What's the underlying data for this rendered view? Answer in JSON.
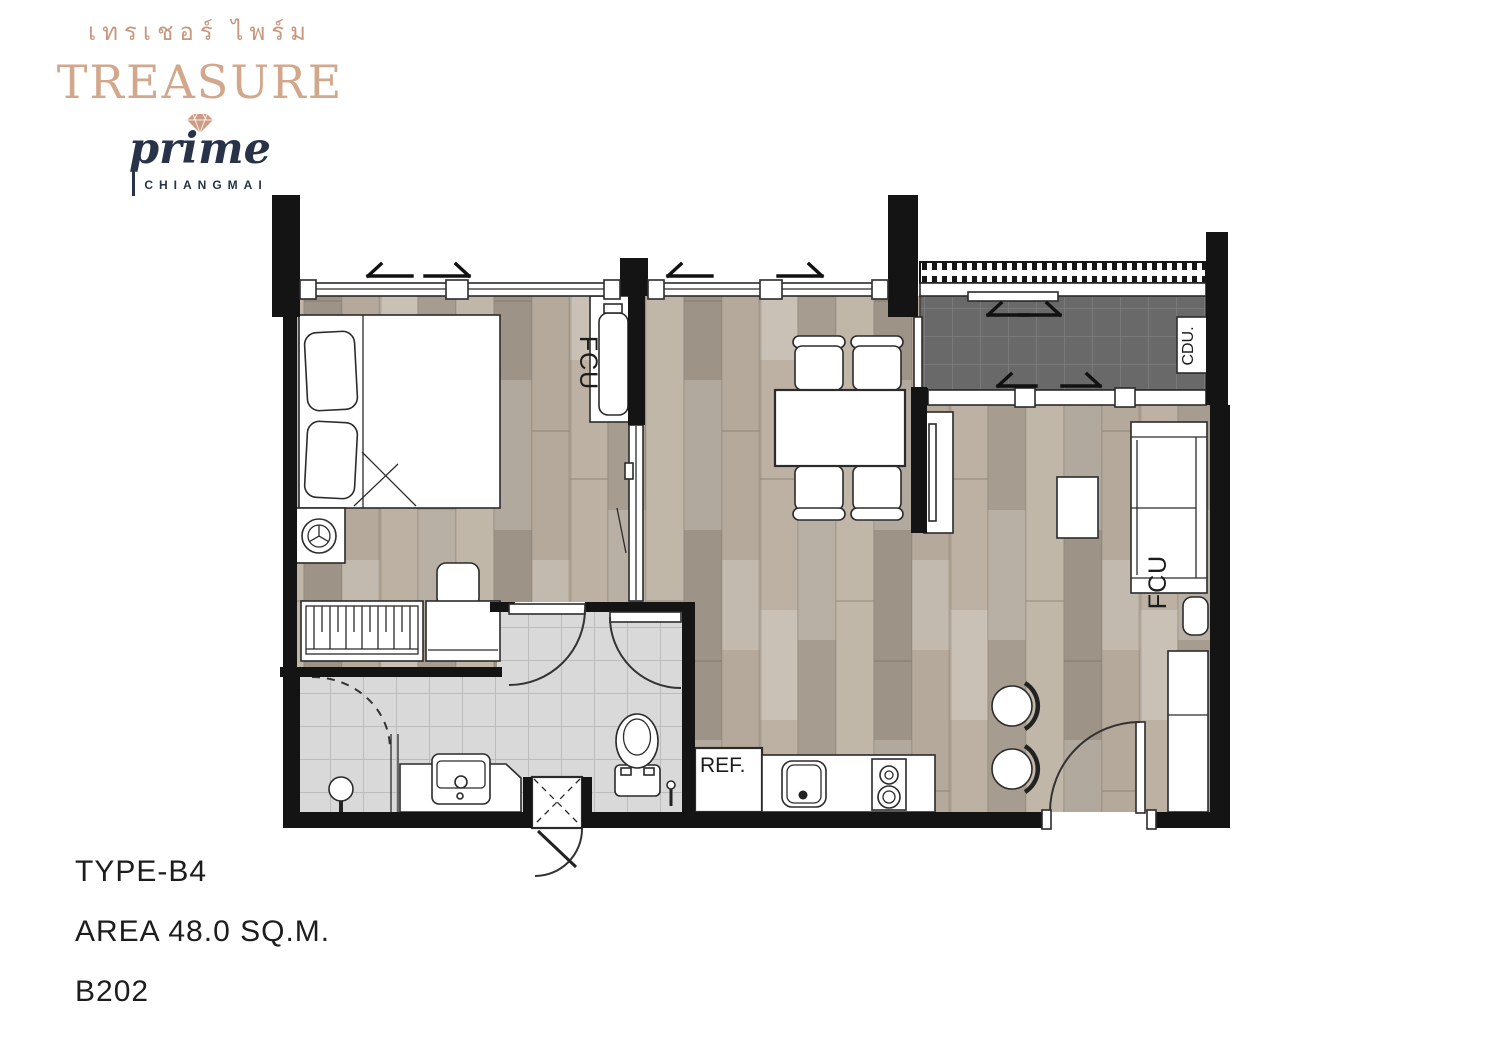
{
  "logo": {
    "thai": "เทรเชอร์ ไพร์ม",
    "brand": "TREASURE",
    "sub": "prime",
    "city": "CHIANGMAI"
  },
  "labels": {
    "fcu_bedroom": "FCU",
    "fcu_living": "FCU",
    "cdu": "CDU.",
    "ref": "REF."
  },
  "info": {
    "type": "TYPE-B4",
    "area": "AREA 48.0 SQ.M.",
    "unit": "B202"
  },
  "colors": {
    "brand_tan": "#d2a78c",
    "brand_navy": "#28334a",
    "wall_black": "#141414",
    "wood_floor": "#b2a799",
    "balcony_tile": "#696969",
    "bath_tile": "#d9d9d9"
  }
}
